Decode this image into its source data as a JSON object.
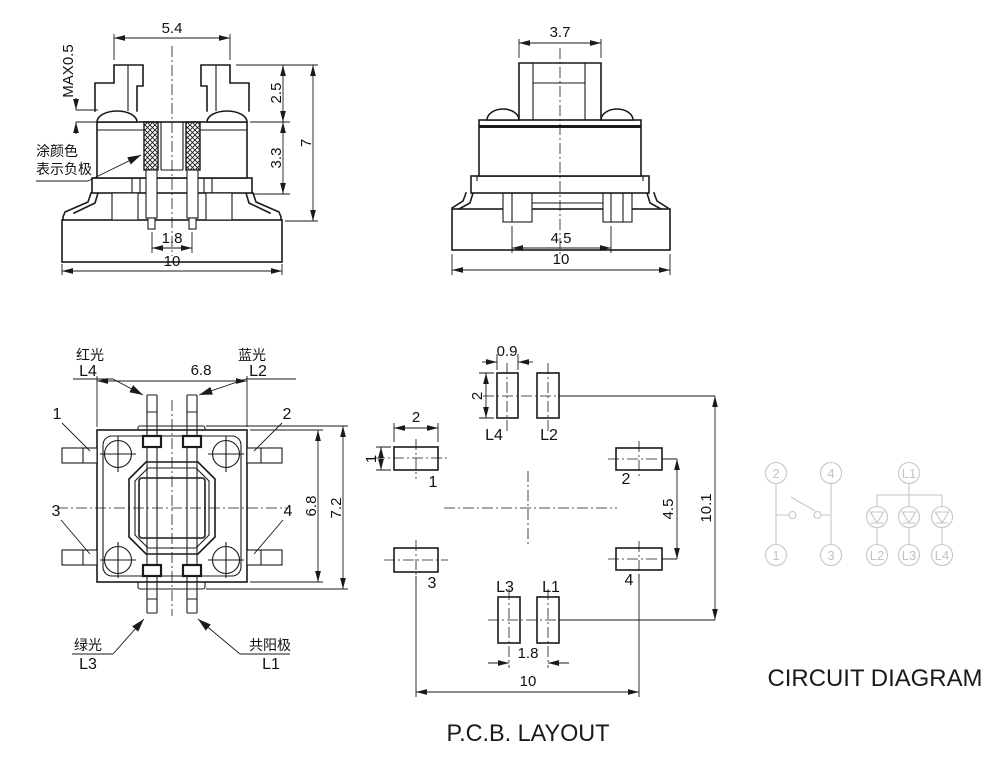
{
  "front_view": {
    "dim_cap_width": "5.4",
    "dim_standoff": "MAX0.5",
    "dim_upper_height": "2.5",
    "dim_body_height": "3.3",
    "dim_total_height": "7",
    "dim_pin_pitch": "1.8",
    "dim_base_width": "10",
    "note_line1": "涂颜色",
    "note_line2": "表示负极"
  },
  "side_view": {
    "dim_stem_width": "3.7",
    "dim_pin_span": "4.5",
    "dim_base_width": "10"
  },
  "top_view": {
    "label_red": "红光",
    "label_red_pin": "L4",
    "label_blue": "蓝光",
    "label_blue_pin": "L2",
    "label_green": "绿光",
    "label_green_pin": "L3",
    "label_anode": "共阳极",
    "label_anode_pin": "L1",
    "pin1": "1",
    "pin2": "2",
    "pin3": "3",
    "pin4": "4",
    "dim_width": "6.8",
    "dim_height": "6.8",
    "dim_overall": "7.2"
  },
  "pcb_layout": {
    "title": "P.C.B. LAYOUT",
    "dim_led_pad_width": "0.9",
    "dim_led_pad_height": "2",
    "dim_pad_width": "2",
    "dim_pad_height": "1",
    "dim_pad_span": "4.5",
    "dim_led_span": "10.1",
    "dim_led_pitch": "1.8",
    "dim_pad_pitch": "10",
    "pad1": "1",
    "pad2": "2",
    "pad3": "3",
    "pad4": "4",
    "led1": "L1",
    "led2": "L2",
    "led3": "L3",
    "led4": "L4"
  },
  "circuit_diagram": {
    "title": "CIRCUIT DIAGRAM",
    "t1": "1",
    "t2": "2",
    "t3": "3",
    "t4": "4",
    "l1": "L1",
    "l2": "L2",
    "l3": "L3",
    "l4": "L4"
  }
}
